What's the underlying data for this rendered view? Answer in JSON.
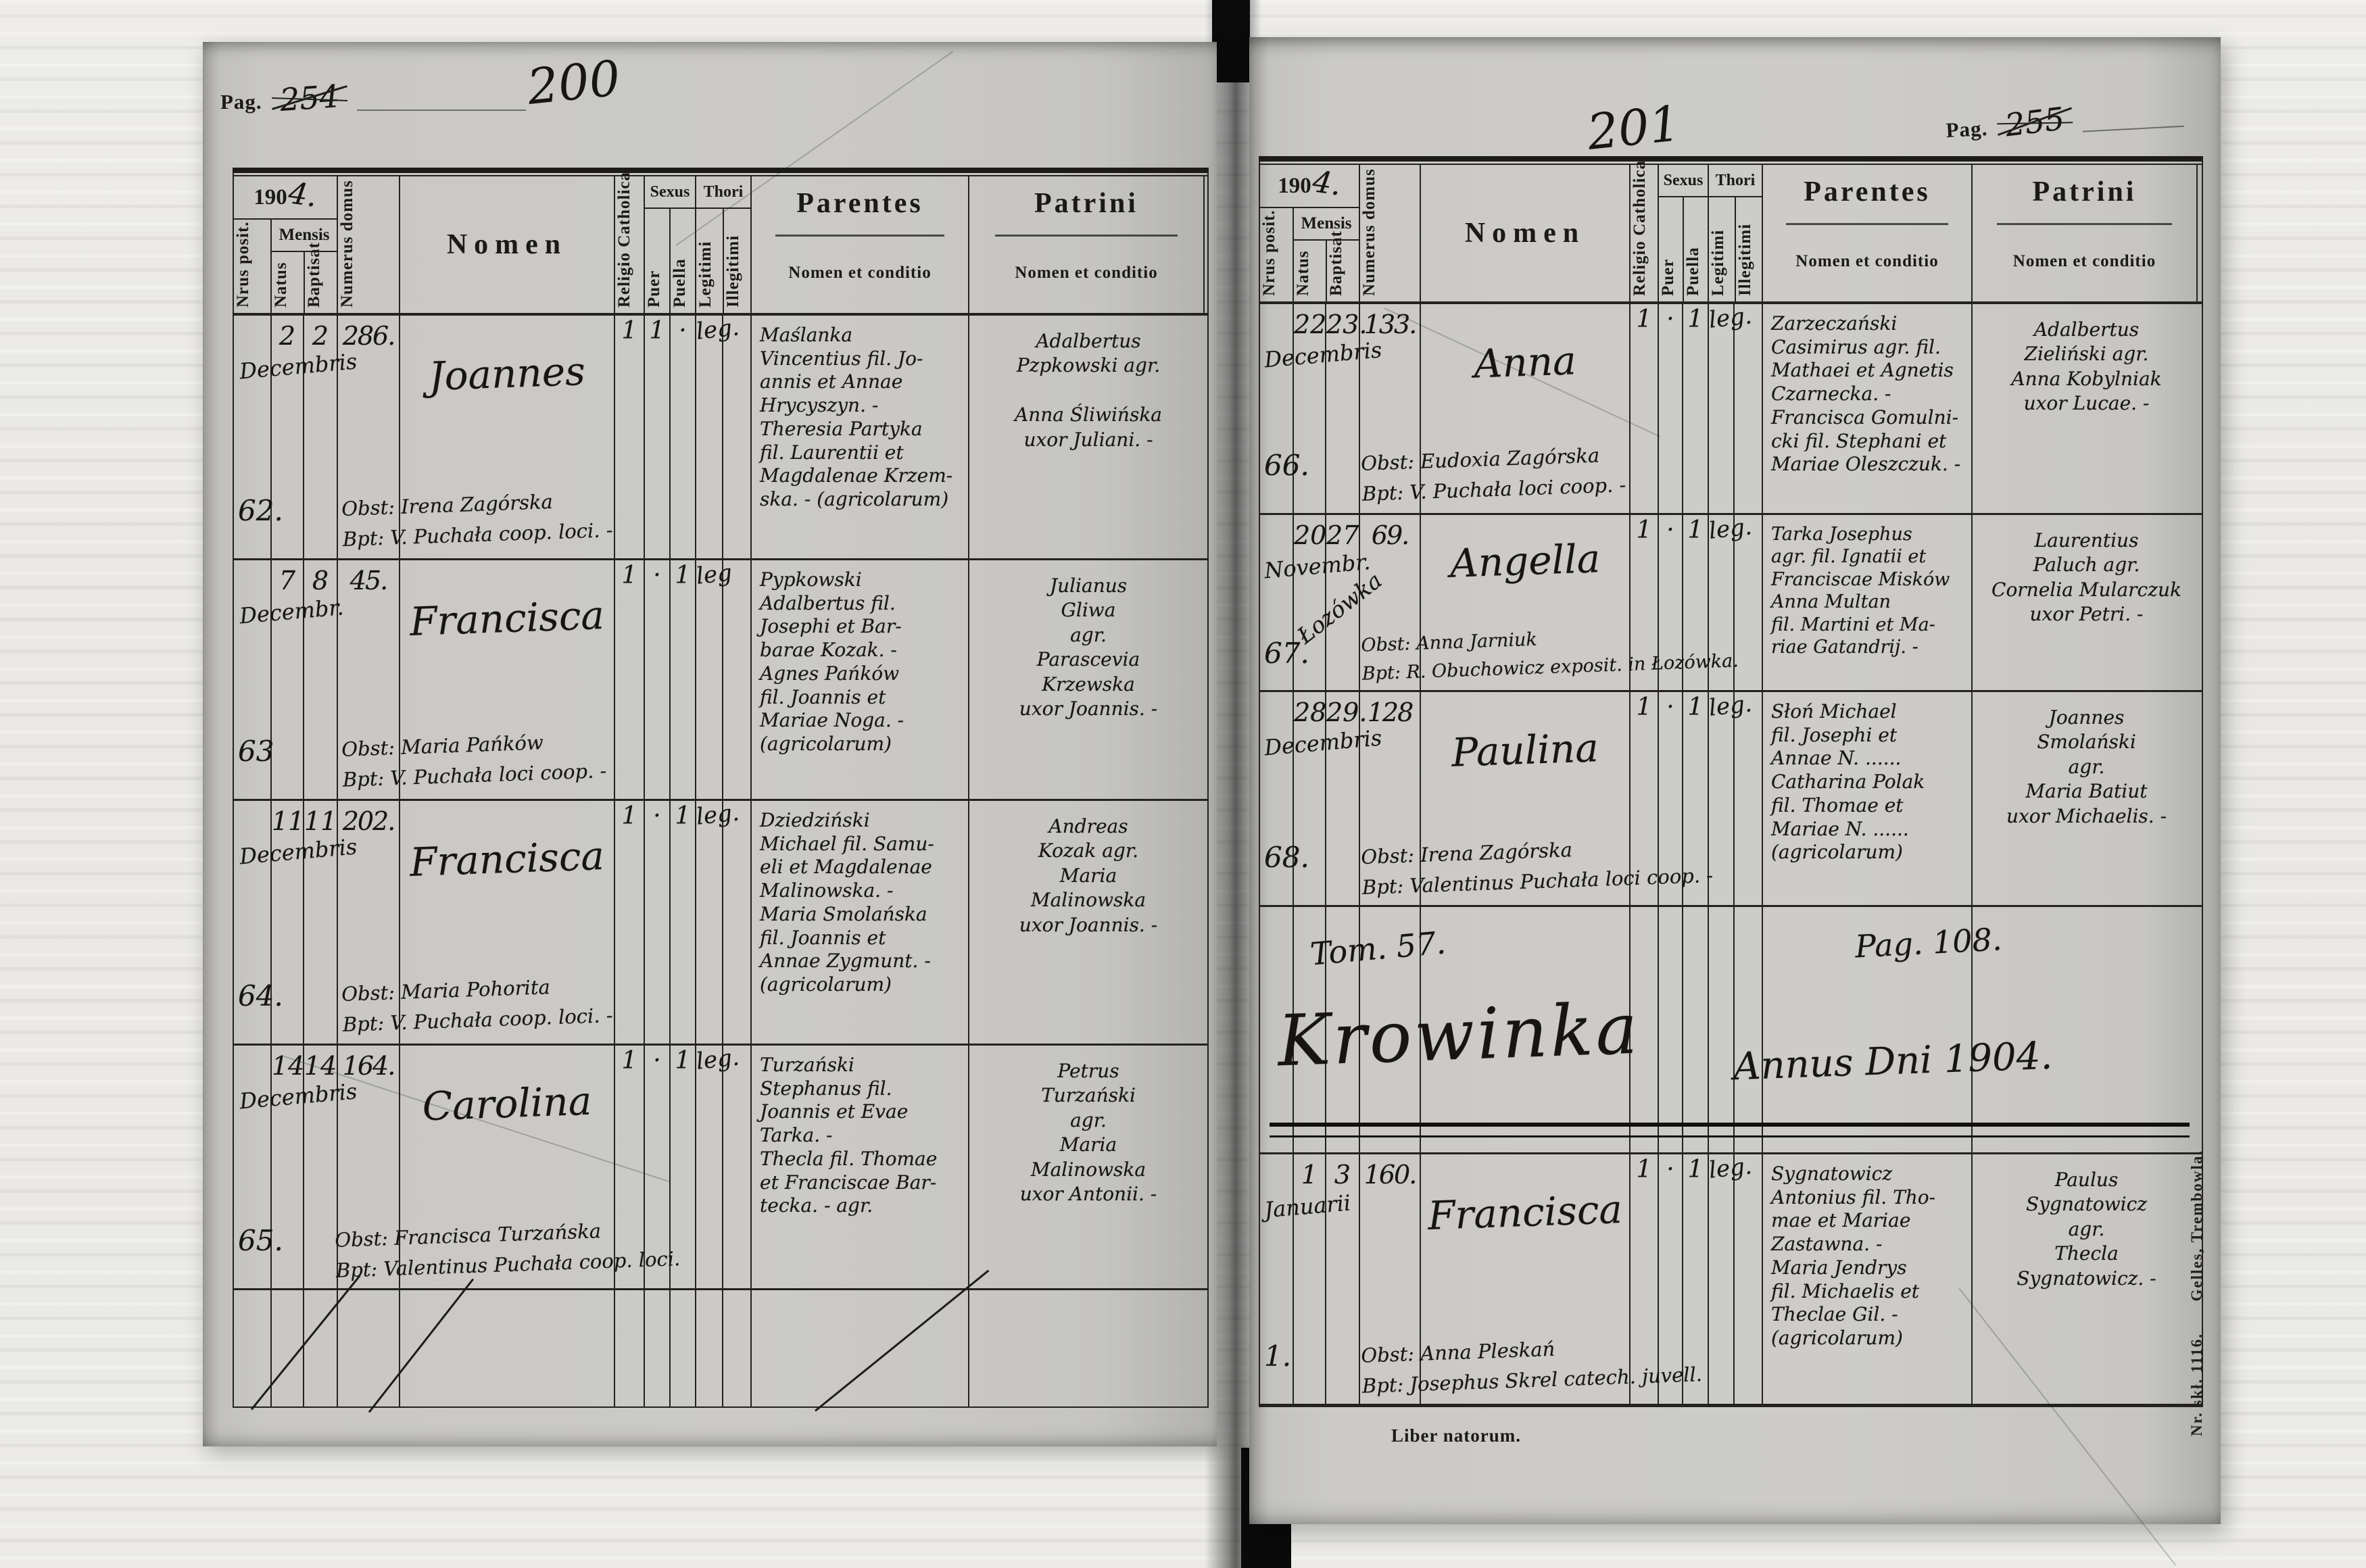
{
  "header": {
    "year_printed": "190",
    "year_hand": "4.",
    "nrus_posit": "Nrus posit.",
    "mensis": "Mensis",
    "natus": "Natus",
    "baptisat": "Baptisat",
    "numerus_domus": "Numerus domus",
    "nomen": "Nomen",
    "religio": "Religio Catholica",
    "sexus": "Sexus",
    "puer": "Puer",
    "puella": "Puella",
    "thori": "Thori",
    "legitimi": "Legitimi",
    "illegitimi": "Illegitimi",
    "parentes": "Parentes",
    "patrini": "Patrini",
    "nomen_et_conditio": "Nomen et conditio"
  },
  "left_page": {
    "pag_label": "Pag.",
    "old_number": "254",
    "hand_number": "200",
    "rows": [
      {
        "nr": "62.",
        "natus": "2",
        "baptisat": "2",
        "mensis": "Decembris",
        "domus": "286.",
        "nomen": "Joannes",
        "religio": "1",
        "puer": "1",
        "puella": "·",
        "thori": "leg.",
        "parentes": "Maślanka\nVincentius fil. Jo-\nannis et Annae\nHrycyszyn. -\nTheresia Partyka\nfil. Laurentii et\nMagdalenae Krzem-\nska. - (agricolarum)",
        "patrini": "Adalbertus\nPzpkowski  agr.\n\nAnna Śliwińska\nuxor Juliani. -",
        "obst": "Obst: Irena Zagórska",
        "bpt": "Bpt: V. Puchała coop. loci. -"
      },
      {
        "nr": "63",
        "natus": "7",
        "baptisat": "8",
        "mensis": "Decembr.",
        "domus": "45.",
        "nomen": "Francisca",
        "religio": "1",
        "puer": "·",
        "puella": "1",
        "thori": "leg",
        "parentes": "Pypkowski\nAdalbertus fil.\nJosephi et Bar-\nbarae Kozak. -\nAgnes Pańków\nfil. Joannis et\nMariae Noga. -\n(agricolarum)",
        "patrini": "Julianus\nGliwa\nagr.\nParascevia\nKrzewska\nuxor Joannis. -",
        "obst": "Obst: Maria Pańków",
        "bpt": "Bpt: V. Puchała loci coop. -"
      },
      {
        "nr": "64.",
        "natus": "11",
        "baptisat": "11",
        "mensis": "Decembris",
        "domus": "202.",
        "nomen": "Francisca",
        "religio": "1",
        "puer": "·",
        "puella": "1",
        "thori": "leg.",
        "parentes": "Dziedziński\nMichael fil. Samu-\neli et Magdalenae\nMalinowska. -\nMaria Smolańska\nfil. Joannis et\nAnnae Zygmunt. -\n(agricolarum)",
        "patrini": "Andreas\nKozak  agr.\nMaria\nMalinowska\nuxor Joannis. -",
        "obst": "Obst: Maria Pohorita",
        "bpt": "Bpt: V. Puchała coop. loci. -"
      },
      {
        "nr": "65.",
        "natus": "14",
        "baptisat": "14",
        "mensis": "Decembris",
        "domus": "164.",
        "nomen": "Carolina",
        "religio": "1",
        "puer": "·",
        "puella": "1",
        "thori": "leg.",
        "parentes": "Turzański\nStephanus fil.\nJoannis et Evae\nTarka. -\nThecla fil. Thomae\net Franciscae Bar-\ntecka. -  agr.",
        "patrini": "Petrus\nTurzański\nagr.\nMaria\nMalinowska\nuxor Antonii. -",
        "obst": "Obst: Francisca Turzańska",
        "bpt": "Bpt: Valentinus Puchała coop. loci."
      }
    ]
  },
  "right_page": {
    "pag_label": "Pag.",
    "old_number": "255",
    "hand_number": "201",
    "rows": [
      {
        "nr": "66.",
        "natus": "22",
        "baptisat": "23.",
        "mensis": "Decembris",
        "domus": "133.",
        "nomen": "Anna",
        "religio": "1",
        "puer": "·",
        "puella": "1",
        "thori": "leg.",
        "parentes": "Zarzeczański\nCasimirus agr. fil.\nMathaei et Agnetis\nCzarnecka. -\nFrancisca Gomulni-\ncki fil. Stephani et\nMariae Oleszczuk. -",
        "patrini": "Adalbertus\nZieliński  agr.\nAnna Kobylniak\nuxor Lucae. -",
        "obst": "Obst: Eudoxia Zagórska",
        "bpt": "Bpt: V. Puchała loci coop. -"
      },
      {
        "nr": "67.",
        "natus": "20",
        "baptisat": "27",
        "mensis": "Novembr.",
        "note": "Łozówka",
        "domus": "69.",
        "nomen": "Angella",
        "religio": "1",
        "puer": "·",
        "puella": "1",
        "thori": "leg.",
        "parentes": "Tarka Josephus\nagr. fil. Ignatii et\nFranciscae Misków\nAnna Multan\nfil. Martini et Ma-\nriae Gatandrij. -",
        "patrini": "Laurentius\nPaluch  agr.\nCornelia Mularczuk\nuxor Petri. -",
        "obst": "Obst: Anna Jarniuk",
        "bpt": "Bpt: R. Obuchowicz exposit. in Łozówka."
      },
      {
        "nr": "68.",
        "natus": "28",
        "baptisat": "29.",
        "mensis": "Decembris",
        "domus": "128",
        "nomen": "Paulina",
        "religio": "1",
        "puer": "·",
        "puella": "1",
        "thori": "leg.",
        "parentes": "Słoń Michael\nfil. Josephi et\nAnnae N. ......\nCatharina Polak\nfil. Thomae et\nMariae N. ......\n(agricolarum)",
        "patrini": "Joannes\nSmolański\nagr.\nMaria Batiut\nuxor Michaelis. -",
        "obst": "Obst: Irena Zagórska",
        "bpt": "Bpt: Valentinus Puchała loci coop. -"
      }
    ],
    "section": {
      "tom": "Tom. 57.",
      "pag": "Pag. 108.",
      "place": "Krowinka",
      "annus": "Annus Dni 1904."
    },
    "last_row": {
      "nr": "1.",
      "natus": "1",
      "baptisat": "3",
      "mensis": "Januarii",
      "domus": "160.",
      "nomen": "Francisca",
      "religio": "1",
      "puer": "·",
      "puella": "1",
      "thori": "leg.",
      "parentes": "Sygnatowicz\nAntonius fil. Tho-\nmae et Mariae\nZastawna. -\nMaria Jendrys\nfil. Michaelis et\nTheclae Gil. -\n(agricolarum)",
      "patrini": "Paulus\nSygnatowicz\nagr.\nThecla\nSygnatowicz. -",
      "obst": "Obst: Anna Pleskań",
      "bpt": "Bpt: Josephus Skrel catech. juvell."
    },
    "footer": "Liber natorum.",
    "imprint": "Nr. skł. 1116.      Gelles, Trembowla."
  }
}
